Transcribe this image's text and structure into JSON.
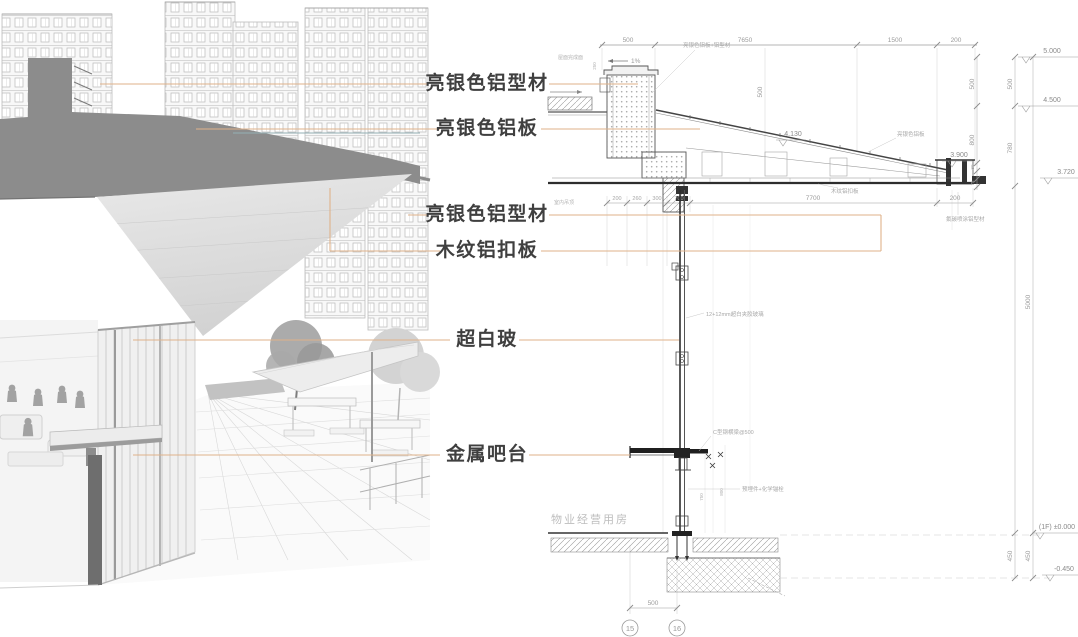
{
  "callouts": [
    "亮银色铝型材",
    "亮银色铝板",
    "亮银色铝型材",
    "木纹铝扣板",
    "超白玻",
    "金属吧台"
  ],
  "drawing": {
    "top_dims": [
      "500",
      "7650",
      "1500",
      "200"
    ],
    "levels": {
      "l5000": "5.000",
      "l4500": "4.500",
      "l3720": "3.720",
      "l4130": "4.130",
      "l3900": "3.900",
      "l0": "(1F) ±0.000",
      "lm450": "-0.450"
    },
    "vdims": {
      "c1a": "500",
      "c1b": "800",
      "c1c": "80",
      "c1d": "75",
      "c2a": "500",
      "c2b": "780",
      "c2c": "450",
      "c3a": "5000",
      "c3b": "450"
    },
    "under_dims": [
      "200",
      "260",
      "300",
      "700",
      "7700",
      "200"
    ],
    "roof": {
      "slope": "1%",
      "vdim": "500",
      "pdim": "250"
    },
    "mid_vdims": [
      "750",
      "800"
    ],
    "bottom": {
      "dim": "500",
      "bubble1": "15",
      "bubble2": "16"
    },
    "watermark": "物业经营用房",
    "annotations": {
      "a1": "亮银色铝板+铝型材",
      "a2": "屋面完成面",
      "a3": "亮银色铝板",
      "a4": "氟碳喷涂铝型材",
      "a5": "木纹铝扣板",
      "a6": "12+12mm超白夹胶玻璃",
      "a7": "C型钢横梁@500",
      "a8": "预埋件+化学锚栓",
      "a9": "室内吊顶"
    },
    "accent_color": "#dfb28a",
    "teal_color": "#93afb4"
  }
}
